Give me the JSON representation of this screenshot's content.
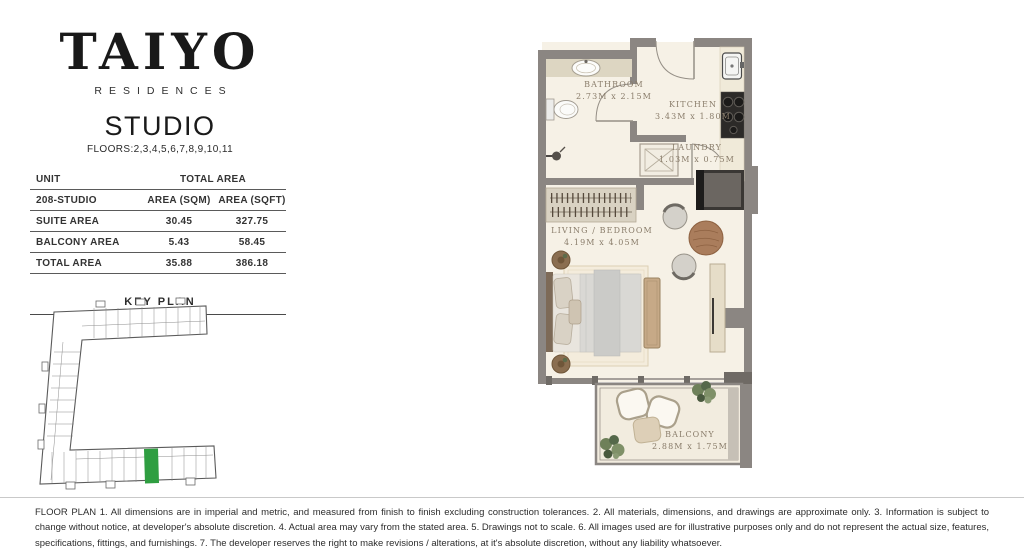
{
  "brand": {
    "logo": "TAIYO",
    "sub": "RESIDENCES"
  },
  "unit": {
    "type": "STUDIO",
    "floors": "FLOORS:2,3,4,5,6,7,8,9,10,11"
  },
  "area_table": {
    "header": {
      "unit_label": "UNIT",
      "total_area_label": "TOTAL AREA"
    },
    "subheader": {
      "unit_id": "208-STUDIO",
      "sqm_label": "AREA (SQM)",
      "sqft_label": "AREA (SQFT)"
    },
    "rows": [
      {
        "label": "SUITE AREA",
        "sqm": "30.45",
        "sqft": "327.75"
      },
      {
        "label": "BALCONY AREA",
        "sqm": "5.43",
        "sqft": "58.45"
      },
      {
        "label": "TOTAL AREA",
        "sqm": "35.88",
        "sqft": "386.18"
      }
    ]
  },
  "key_plan": {
    "title": "KEY PLAN"
  },
  "floor_plan": {
    "rooms": [
      {
        "name": "BATHROOM",
        "dims": "2.73M x 2.15M"
      },
      {
        "name": "KITCHEN",
        "dims": "3.43M x 1.80M"
      },
      {
        "name": "LAUNDRY",
        "dims": "1.03M x 0.75M"
      },
      {
        "name": "LIVING / BEDROOM",
        "dims": "4.19M x 4.05M"
      },
      {
        "name": "BALCONY",
        "dims": "2.88M x 1.75M"
      }
    ],
    "colors": {
      "wall": "#8b8682",
      "floor": "#f6f1e6",
      "balcony_floor": "#f2ecdf",
      "highlight": "#2f9e41"
    }
  },
  "disclaimer": "FLOOR PLAN 1. All dimensions are in imperial and metric, and measured from finish to finish excluding construction tolerances. 2. All materials, dimensions, and drawings are approximate only. 3. Information is subject to change without notice, at developer's absolute discretion. 4. Actual area may vary from the stated area. 5. Drawings not to scale. 6. All images used are for illustrative purposes only and do not represent the actual size, features, specifications, fittings, and furnishings. 7. The developer reserves the right to make revisions / alterations, at it's absolute discretion, without any liability whatsoever."
}
